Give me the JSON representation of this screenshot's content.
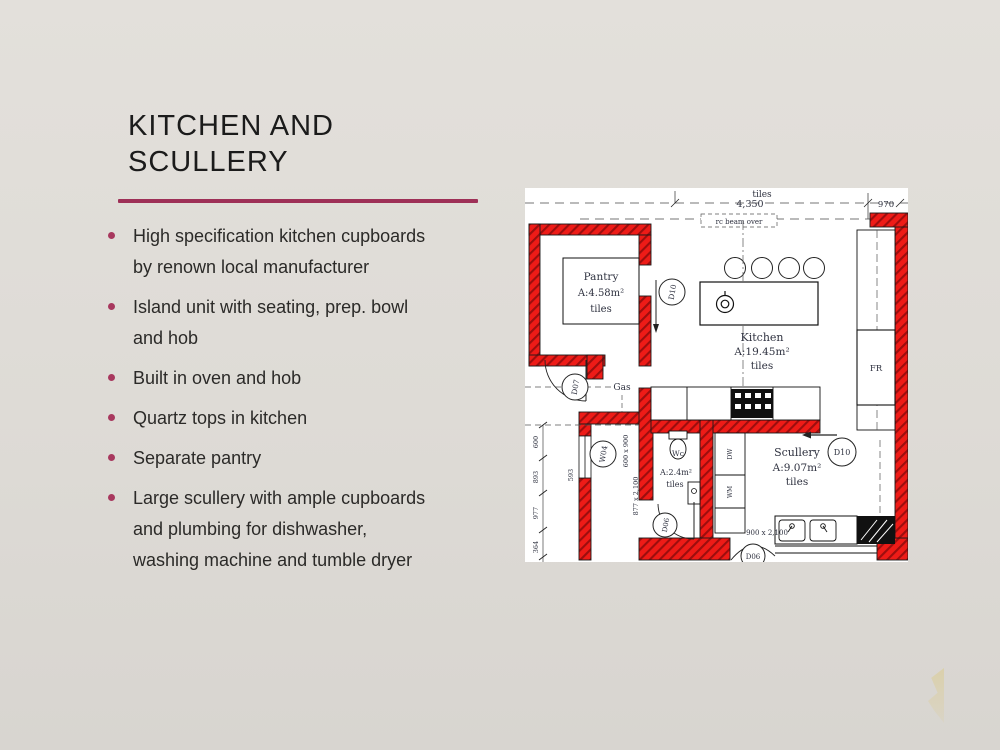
{
  "slide": {
    "title_line1": "KITCHEN AND",
    "title_line2": "SCULLERY",
    "accent_color": "#9e3057",
    "bullets": [
      {
        "lines": [
          "High specification kitchen cupboards",
          "by renown local manufacturer"
        ]
      },
      {
        "lines": [
          "Island unit with seating, prep. bowl",
          "and hob"
        ]
      },
      {
        "lines": [
          "Built in oven and hob"
        ]
      },
      {
        "lines": [
          "Quartz tops in kitchen"
        ]
      },
      {
        "lines": [
          "Separate pantry"
        ]
      },
      {
        "lines": [
          "Large scullery with ample cupboards",
          "and plumbing for dishwasher,",
          "washing machine and tumble dryer"
        ]
      }
    ]
  },
  "floorplan": {
    "wall_color": "#ee1b17",
    "top": {
      "room_above_floor": "tiles",
      "width_dim": "4,350",
      "right_dim": "970",
      "beam_note": "rc beam over"
    },
    "pantry": {
      "name": "Pantry",
      "area": "A:4.58m²",
      "floor": "tiles"
    },
    "kitchen": {
      "name": "Kitchen",
      "area": "A:19.45m²",
      "floor": "tiles"
    },
    "wc": {
      "fixture": "Wc",
      "area": "A:2.4m²",
      "floor": "tiles"
    },
    "scullery": {
      "name": "Scullery",
      "area": "A:9.07m²",
      "floor": "tiles"
    },
    "doors": {
      "d07": "D07",
      "d10_pantry": "D10",
      "d10_scullery": "D10",
      "d06_wc": "D06",
      "d06_rear": "D06",
      "w04": "W04"
    },
    "labels": {
      "gas": "Gas",
      "fridge": "FR",
      "dw": "DW",
      "wm": "WM"
    },
    "dims": {
      "window": "600 x 900",
      "wc_door": "877 x 2,100",
      "rear_door": "900 x 2,100",
      "passage": "593",
      "chain": [
        "600",
        "893",
        "977",
        "364"
      ]
    }
  }
}
